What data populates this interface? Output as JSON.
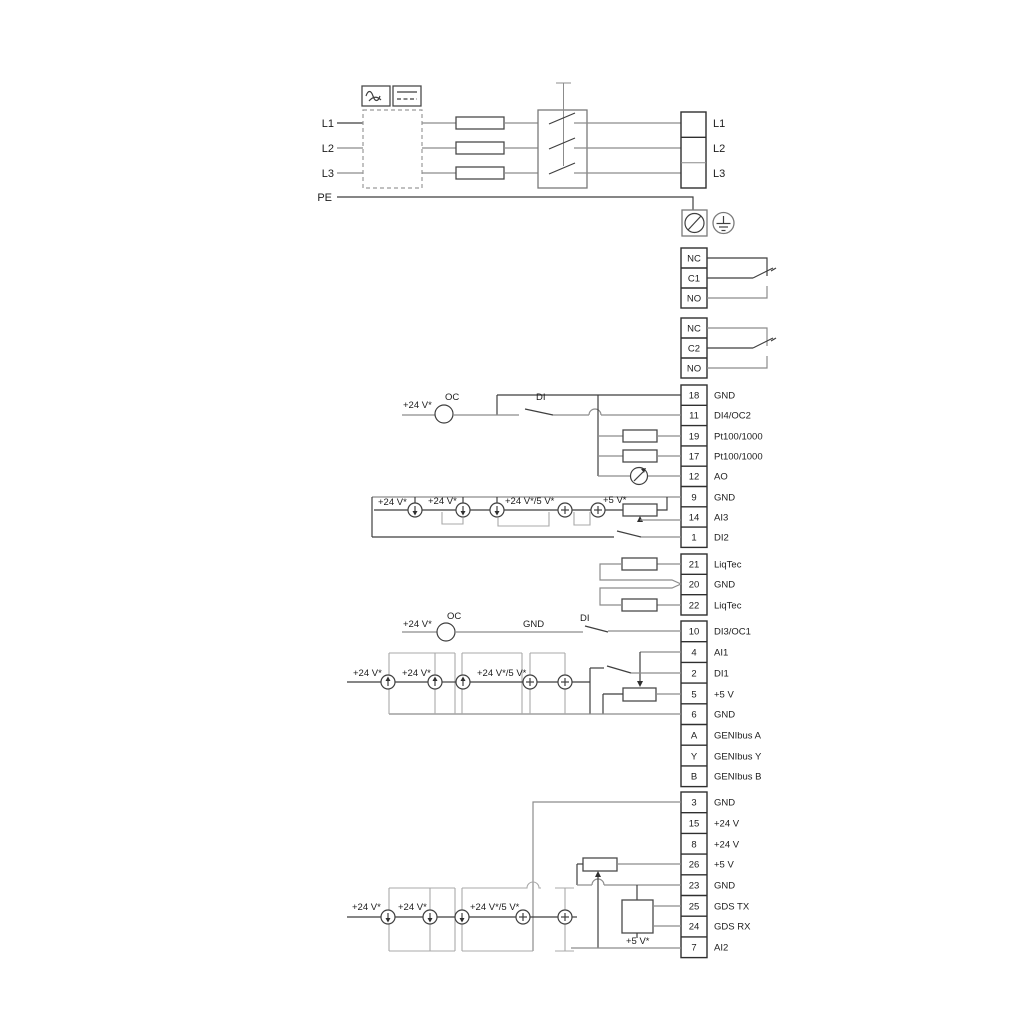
{
  "colors": {
    "background": "#ffffff",
    "wire_gray": "#8c8c8c",
    "line_dark": "#3f3f3f",
    "bracket_gray": "#a8a8a8",
    "text": "#1c1c1c"
  },
  "power": {
    "left": [
      "L1",
      "L2",
      "L3",
      "PE"
    ],
    "right": [
      "L1",
      "L2",
      "L3"
    ],
    "icons": [
      "ac-symbol",
      "dc-symbol",
      "fuse",
      "contactor",
      "cable-screw-terminal",
      "earth-ground"
    ]
  },
  "relay1": {
    "rows": [
      "NC",
      "C1",
      "NO"
    ]
  },
  "relay2": {
    "rows": [
      "NC",
      "C2",
      "NO"
    ]
  },
  "io_a": {
    "rows": [
      {
        "num": "18",
        "label": "GND"
      },
      {
        "num": "11",
        "label": "DI4/OC2"
      },
      {
        "num": "19",
        "label": "Pt100/1000"
      },
      {
        "num": "17",
        "label": "Pt100/1000"
      },
      {
        "num": "12",
        "label": "AO"
      },
      {
        "num": "9",
        "label": "GND"
      },
      {
        "num": "14",
        "label": "AI3"
      },
      {
        "num": "1",
        "label": "DI2"
      }
    ],
    "ann": {
      "v24": "+24 V*",
      "oc": "OC",
      "di": "DI",
      "s1": "+24 V*",
      "s2": "+24 V*",
      "s3": "+24 V*/5 V*",
      "s4": "+5 V*"
    }
  },
  "liqtec": {
    "rows": [
      {
        "num": "21",
        "label": "LiqTec"
      },
      {
        "num": "20",
        "label": "GND"
      },
      {
        "num": "22",
        "label": "LiqTec"
      }
    ]
  },
  "io_b": {
    "rows": [
      {
        "num": "10",
        "label": "DI3/OC1"
      },
      {
        "num": "4",
        "label": "AI1"
      },
      {
        "num": "2",
        "label": "DI1"
      },
      {
        "num": "5",
        "label": "+5 V"
      },
      {
        "num": "6",
        "label": "GND"
      },
      {
        "num": "A",
        "label": "GENIbus A"
      },
      {
        "num": "Y",
        "label": "GENIbus Y"
      },
      {
        "num": "B",
        "label": "GENIbus B"
      }
    ],
    "ann": {
      "v24": "+24 V*",
      "oc": "OC",
      "gnd": "GND",
      "di": "DI",
      "s1": "+24 V*",
      "s2": "+24 V*",
      "s3": "+24 V*/5 V*"
    }
  },
  "io_c": {
    "rows": [
      {
        "num": "3",
        "label": "GND"
      },
      {
        "num": "15",
        "label": "+24 V"
      },
      {
        "num": "8",
        "label": "+24 V"
      },
      {
        "num": "26",
        "label": "+5 V"
      },
      {
        "num": "23",
        "label": "GND"
      },
      {
        "num": "25",
        "label": "GDS TX"
      },
      {
        "num": "24",
        "label": "GDS RX"
      },
      {
        "num": "7",
        "label": "AI2"
      }
    ],
    "ann": {
      "s1": "+24 V*",
      "s2": "+24 V*",
      "s3": "+24 V*/5 V*",
      "v5": "+5 V*"
    }
  }
}
